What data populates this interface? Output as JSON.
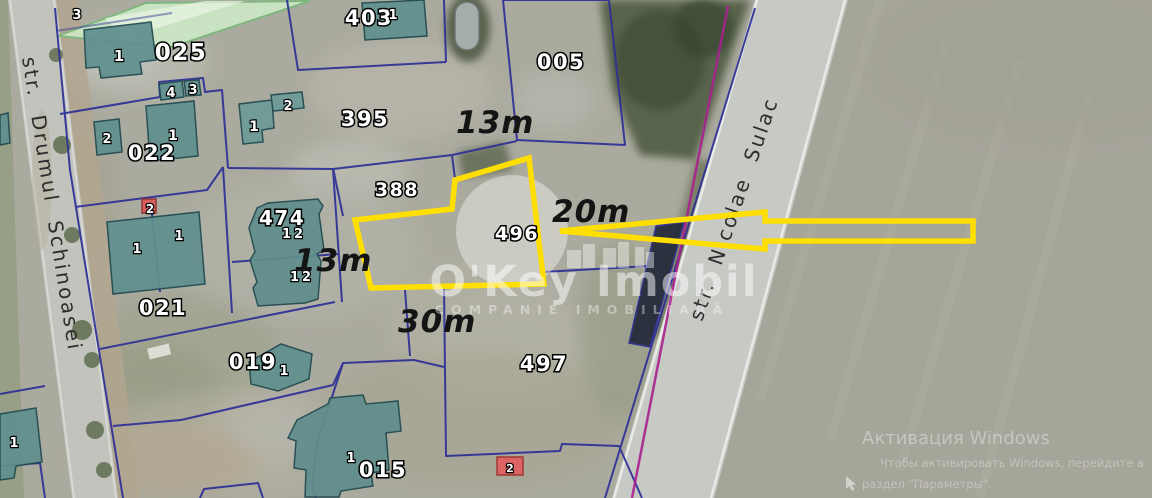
{
  "map": {
    "streets": {
      "left": "str.  Drumul  Schinoasei",
      "right": "str. Nicolae Sulac"
    },
    "parcels": [
      {
        "label": "025"
      },
      {
        "label": "022"
      },
      {
        "label": "403"
      },
      {
        "label": "005"
      },
      {
        "label": "395"
      },
      {
        "label": "388"
      },
      {
        "label": "474"
      },
      {
        "label": "496"
      },
      {
        "label": "021"
      },
      {
        "label": "019"
      },
      {
        "label": "015"
      },
      {
        "label": "497"
      }
    ],
    "building_numbers": [
      {
        "text": "3"
      },
      {
        "text": "1"
      },
      {
        "text": "4"
      },
      {
        "text": "3"
      },
      {
        "text": "2"
      },
      {
        "text": "1"
      },
      {
        "text": "1"
      },
      {
        "text": "2"
      },
      {
        "text": "1"
      },
      {
        "text": "12"
      },
      {
        "text": "12"
      },
      {
        "text": "2"
      },
      {
        "text": "1"
      },
      {
        "text": "1"
      },
      {
        "text": "1"
      },
      {
        "text": "1"
      },
      {
        "text": "1"
      },
      {
        "text": "2"
      }
    ],
    "dimensions": [
      {
        "text": "13m"
      },
      {
        "text": "20m"
      },
      {
        "text": "13m"
      },
      {
        "text": "30m"
      }
    ],
    "brand_watermark": {
      "title": "O'Key Imobil",
      "subtitle": "COMPANIE IMOBILIARĂ"
    },
    "windows_watermark": {
      "line1": "Активация Windows",
      "line2": "Чтобы активировать Windows, перейдите в",
      "line3": "раздел \"Параметры\"."
    },
    "colors": {
      "highlight_yellow": "#ffdf00",
      "boundary_blue": "#2d2f96",
      "cadastral_magenta": "#a8208e",
      "building_teal": "#60908e",
      "red_building": "#dd5a5a",
      "road_gray": "#c6c9c4",
      "terrain_gray": "#abaa9f"
    }
  }
}
